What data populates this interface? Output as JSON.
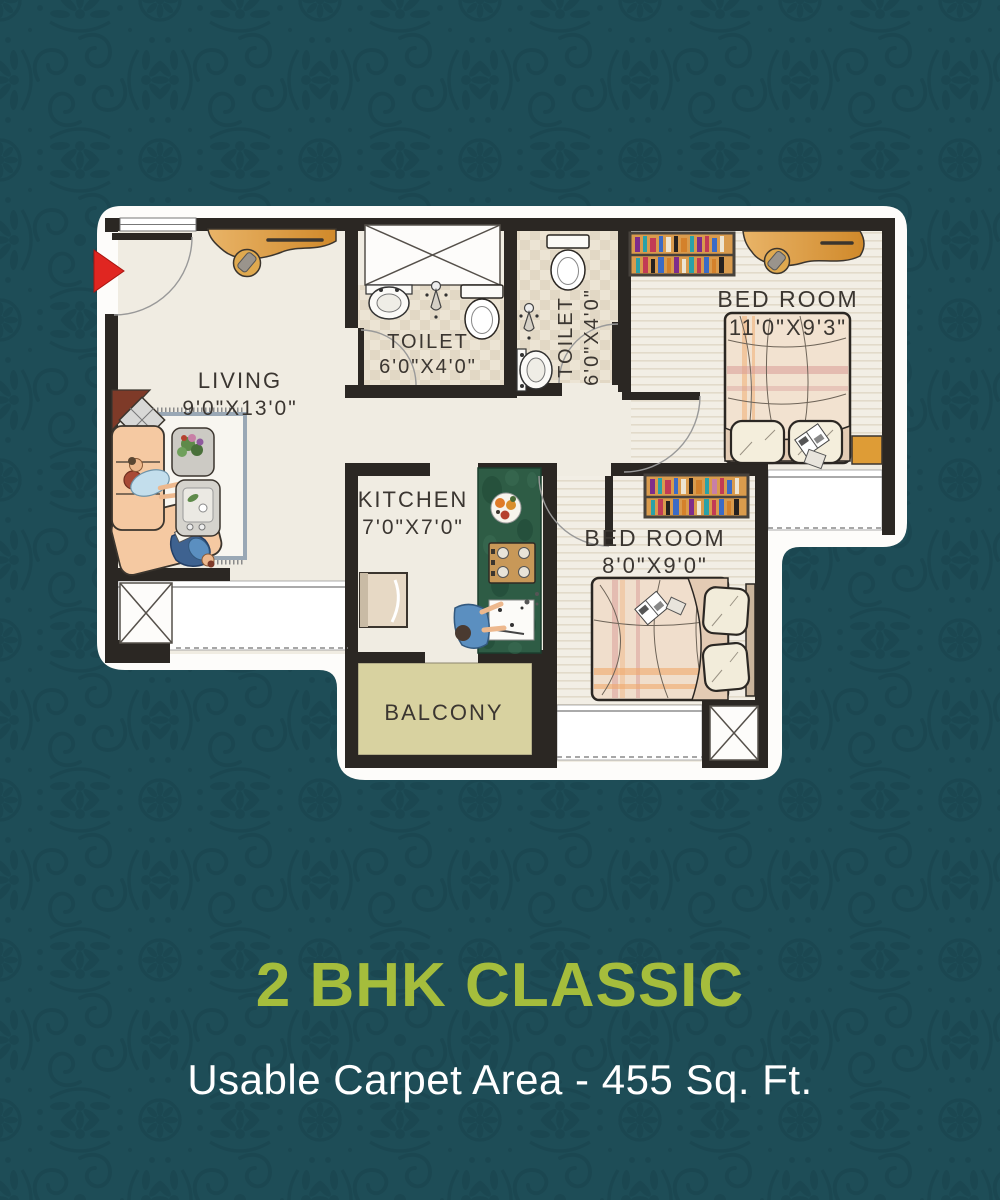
{
  "title": "2 BHK CLASSIC",
  "subtitle": "Usable Carpet Area - 455 Sq. Ft.",
  "plan": {
    "rooms": [
      {
        "name": "LIVING",
        "dims": "9'0\"X13'0\""
      },
      {
        "name": "TOILET",
        "dims": "6'0\"X4'0\""
      },
      {
        "name": "TOILET",
        "dims": "6'0\"X4'0\""
      },
      {
        "name": "KITCHEN",
        "dims": "7'0\"X7'0\""
      },
      {
        "name": "BED ROOM",
        "dims": "11'0\"X9'3\""
      },
      {
        "name": "BED ROOM",
        "dims": "8'0\"X9'0\""
      },
      {
        "name": "BALCONY",
        "dims": ""
      }
    ]
  },
  "colors": {
    "background": "#1E4D57",
    "pattern": "#1A4750",
    "title_green": "#A5BD3C",
    "subtitle_white": "#FFFFFF",
    "wall": "#2B2723",
    "floor": "#F0ECE2",
    "tile": "#DBCEB8",
    "balcony_floor": "#D8D2A0",
    "wood_accent": "#DE9C36",
    "kitchen_counter": "#2E5C45",
    "sofa": "#F5C9A2",
    "bed": "#F2E2D0",
    "entry_arrow": "#E02621"
  }
}
